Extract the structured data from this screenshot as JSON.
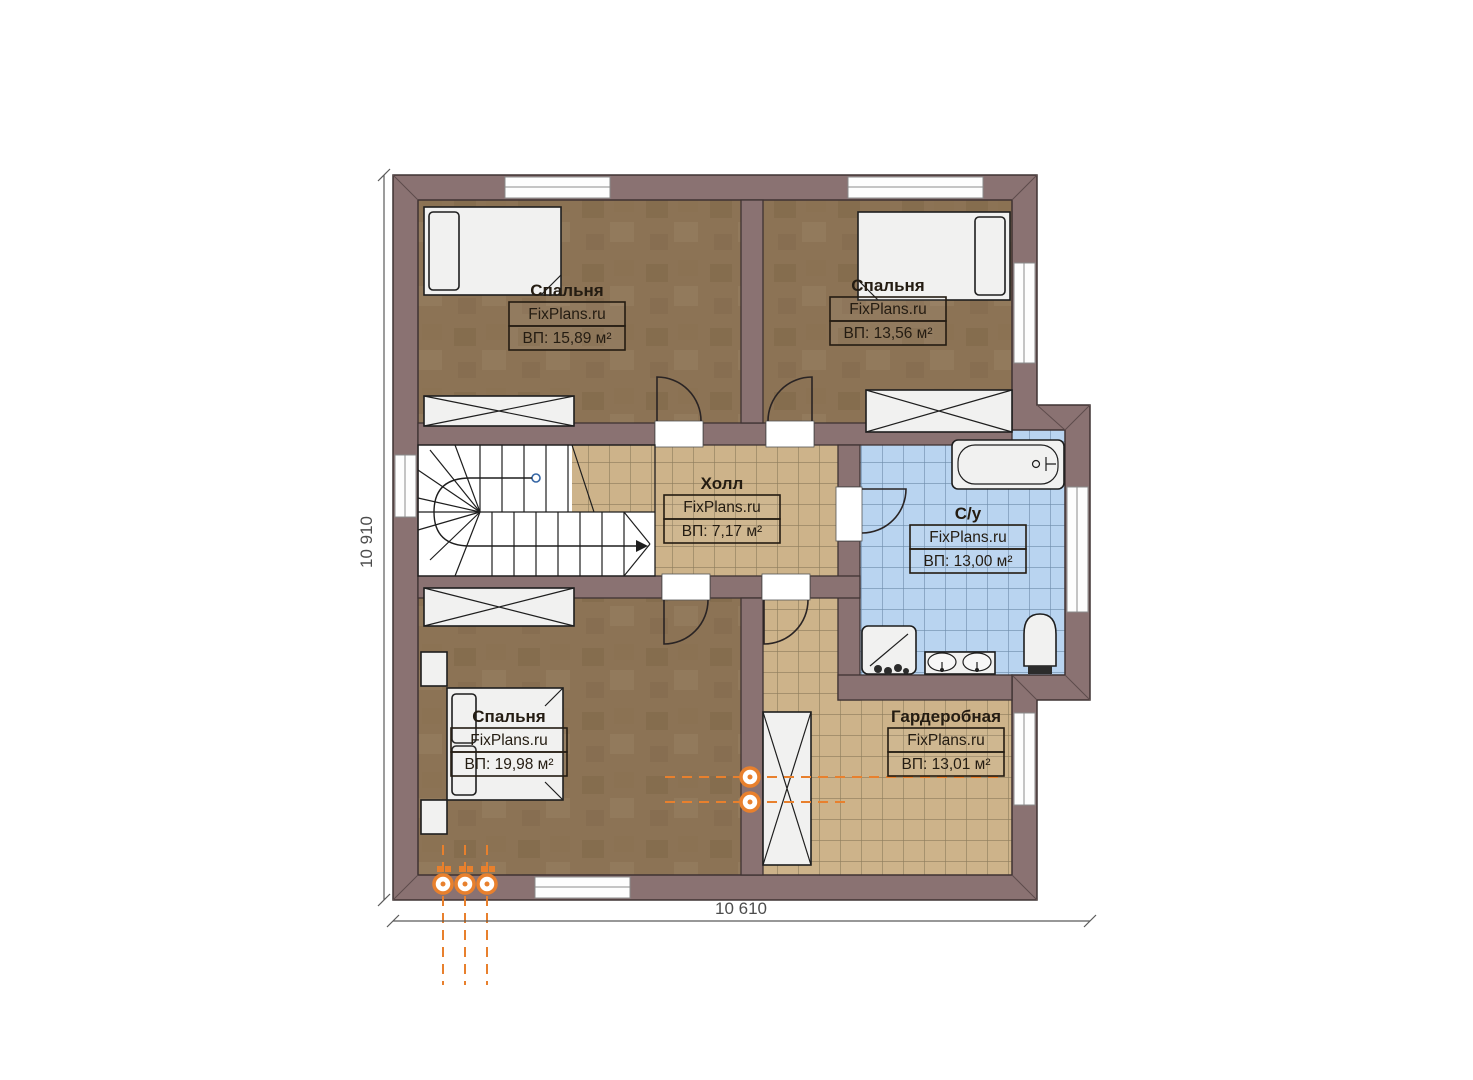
{
  "plan": {
    "brand": "FixPlans.ru",
    "rooms": [
      {
        "id": "bedroom-top-left",
        "name": "Спальня",
        "brand": "FixPlans.ru",
        "area": "ВП: 15,89 м²"
      },
      {
        "id": "bedroom-top-right",
        "name": "Спальня",
        "brand": "FixPlans.ru",
        "area": "ВП: 13,56 м²"
      },
      {
        "id": "hall",
        "name": "Холл",
        "brand": "FixPlans.ru",
        "area": "ВП: 7,17 м²"
      },
      {
        "id": "bathroom",
        "name": "С/у",
        "brand": "FixPlans.ru",
        "area": "ВП: 13,00 м²"
      },
      {
        "id": "bedroom-bottom",
        "name": "Спальня",
        "brand": "FixPlans.ru",
        "area": "ВП: 19,98 м²"
      },
      {
        "id": "wardrobe",
        "name": "Гардеробная",
        "brand": "FixPlans.ru",
        "area": "ВП: 13,01 м²"
      }
    ],
    "dimensions": {
      "height_label": "10 910",
      "width_label": "10 610"
    },
    "colors": {
      "wall": "#8a7272",
      "bedroom_floor": "#8c7355",
      "tile_floor": "#cdb38a",
      "bath_tile": "#b9d4f0",
      "accent_orange": "#e8802d"
    }
  }
}
